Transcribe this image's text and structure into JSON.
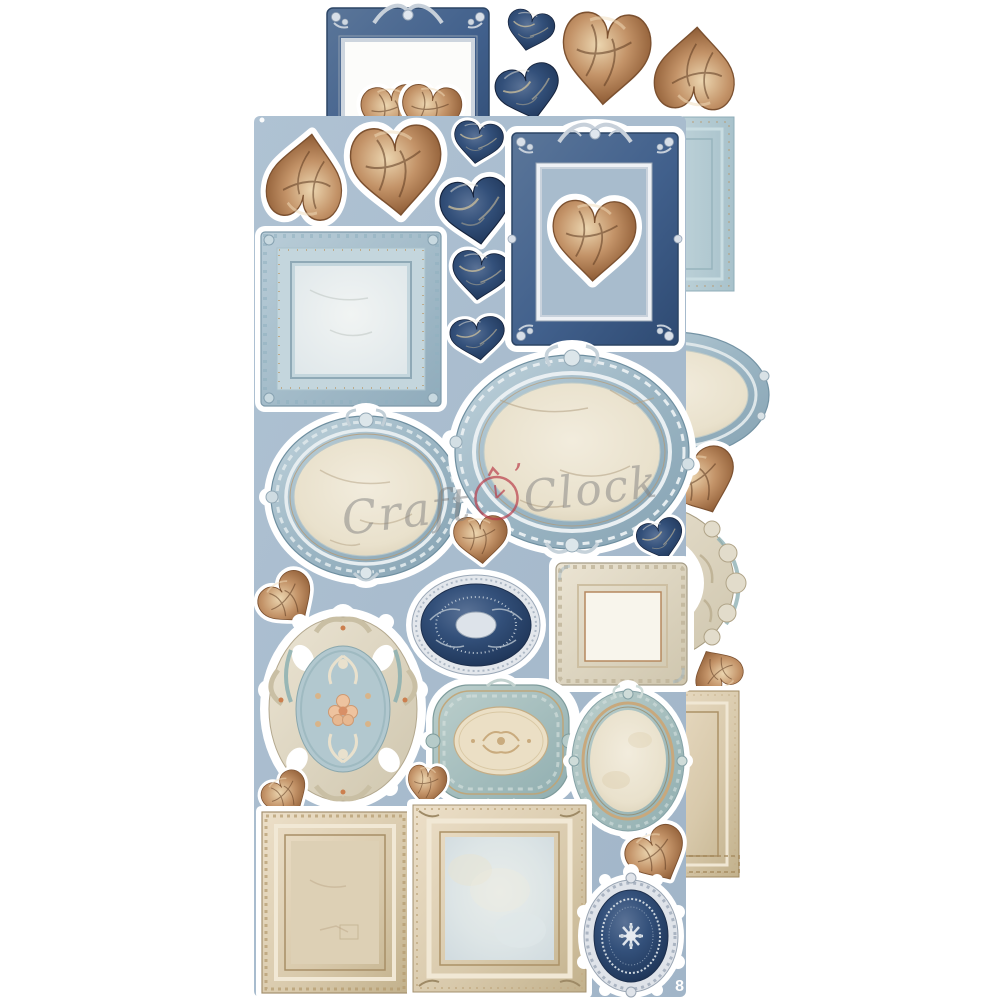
{
  "product": {
    "description": "Die-cut elements sheet photo: ornate baroque frames and cracked-marble hearts in navy, steel blue, cream and brown on a dusty-blue sheet overlapping a white backing sheet"
  },
  "watermark": {
    "text_left": "Craft",
    "apostrophe": "’",
    "text_right": "Clock",
    "text_color": "#7d7d7d",
    "clock_color": "#b93a48"
  },
  "page_number": "8",
  "palette": {
    "front_sheet_blue": "#a8bccd",
    "back_sheet_white": "#ffffff",
    "navy": "#24395c",
    "navy_frame": "#41608c",
    "brown_heart": "#b5835c",
    "cream_parchment": "#ece5d2",
    "steel_blue_frame": "#9cb6c4",
    "beige_frame": "#d6c9ad",
    "silver": "#d4dbe3",
    "teal": "#a9c3c4",
    "sticker_outline": "#ffffff"
  },
  "sheet_front": {
    "background_color": "#a8bccd",
    "pieces": [
      "heart-brown-inverted",
      "heart-brown-large",
      "heart-navy-small",
      "heart-navy-medium",
      "heart-navy-medium-2",
      "heart-navy-small-2",
      "ornate-rect-frame-navy-with-heart",
      "square-frame-lightblue",
      "oval-frame-steelblue",
      "oval-frame-landscape-steelblue",
      "heart-brown-small-mid",
      "heart-navy-small-right",
      "heart-brown-tilted-left",
      "oval-medallion-navy-lace",
      "square-frame-cream-ornate",
      "floral-medallion-rococo",
      "plaque-teal-cartouche",
      "oval-frame-teal-small",
      "heart-brown-small-left",
      "heart-brown-small-center",
      "rect-frame-beige-crackle",
      "square-frame-beige-crackle",
      "heart-brown-bottom-right",
      "oval-medallion-navy-filigree"
    ]
  },
  "sheet_back": {
    "background_color": "#ffffff",
    "pieces": [
      "ornate-rect-frame-navy-top",
      "double-heart-brown",
      "heart-navy-small-top",
      "heart-navy-top",
      "heart-brown-large-top",
      "heart-brown-inverted-top",
      "carved-frame-lightblue-right",
      "oval-frame-blue-right",
      "heart-brown-right",
      "rococo-scroll-frame-right",
      "heart-brown-small-right",
      "carved-frame-beige-right"
    ]
  }
}
